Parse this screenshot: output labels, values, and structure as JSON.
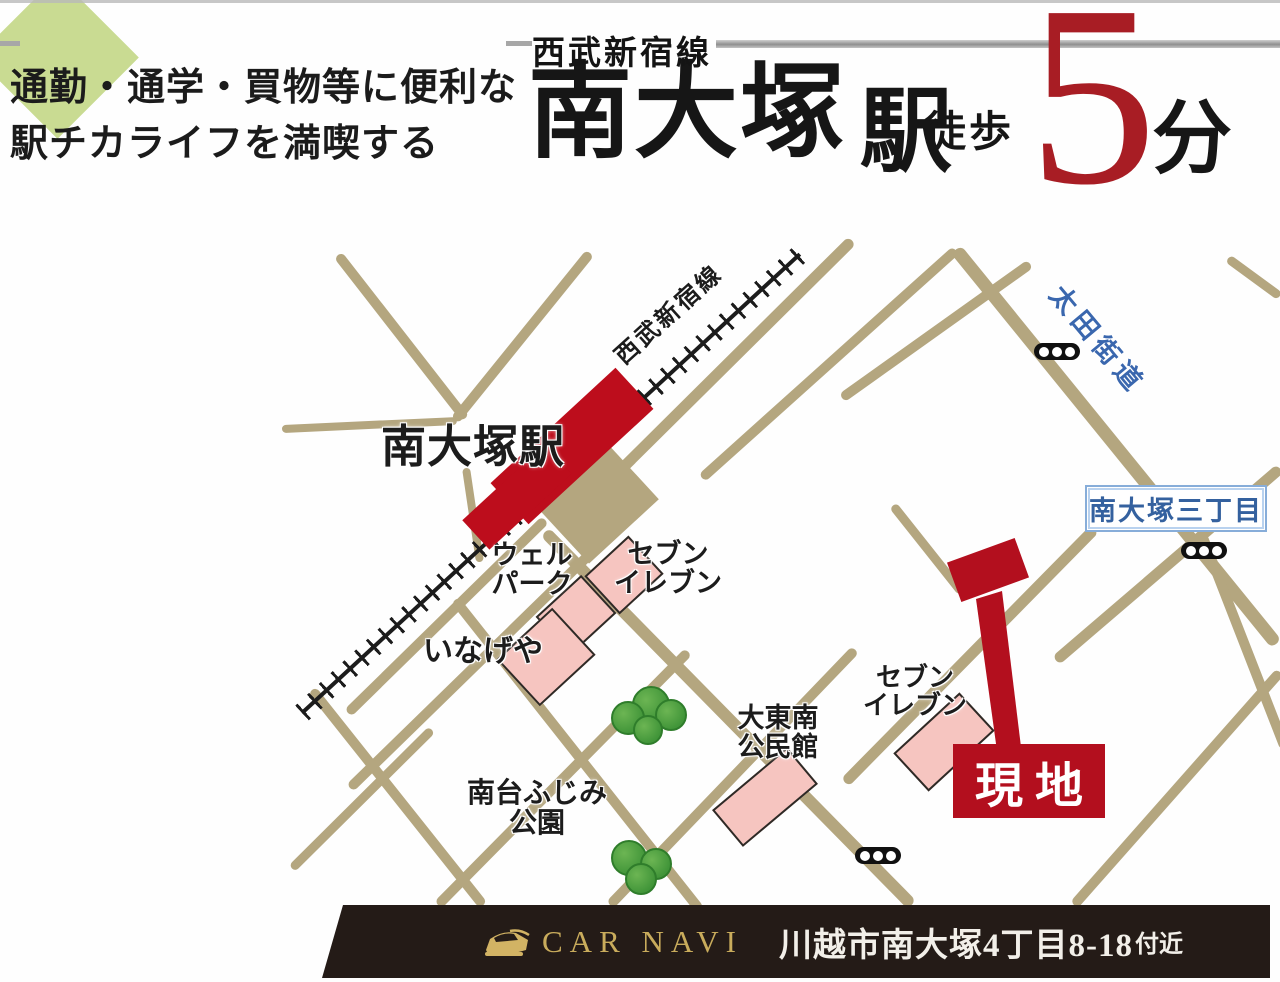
{
  "header": {
    "tagline_line1": "通勤・通学・買物等に便利な",
    "tagline_line2": "駅チカライフを満喫する",
    "rail_line_name": "西武新宿線",
    "station_name": "南大塚",
    "station_suffix": "駅",
    "walk_label": "徒歩",
    "walk_minutes": "5",
    "minutes_unit": "分",
    "accent_red": "#a81d24"
  },
  "map": {
    "railway_label": "西武新宿線",
    "station_label": "南大塚駅",
    "ota_road_label": "太田街道",
    "intersection_label": "南大塚三丁目",
    "site_label": "現地",
    "landmarks": {
      "welpark": {
        "line1": "ウェル",
        "line2": "パーク"
      },
      "seven_eleven_1": {
        "line1": "セブン",
        "line2": "イレブン"
      },
      "inageya": {
        "line1": "いなげや"
      },
      "minamidai_fujimi_park": {
        "line1": "南台ふじみ",
        "line2": "公園"
      },
      "daitonan_kominkan": {
        "line1": "大東南",
        "line2": "公民館"
      },
      "seven_eleven_2": {
        "line1": "セブン",
        "line2": "イレブン"
      }
    },
    "colors": {
      "road": "#b4a67f",
      "railway": "#1c1c1c",
      "station_red": "#bd0d1c",
      "site_red": "#b30f1e",
      "building_pink": "#f6c5c0",
      "park_green": "#c9db92",
      "tree_green": "#4aa03e",
      "blue_text": "#3a67ae"
    }
  },
  "footer": {
    "car_navi_label": "CAR NAVI",
    "address": "川越市南大塚4丁目8-18",
    "address_suffix": "付近"
  }
}
